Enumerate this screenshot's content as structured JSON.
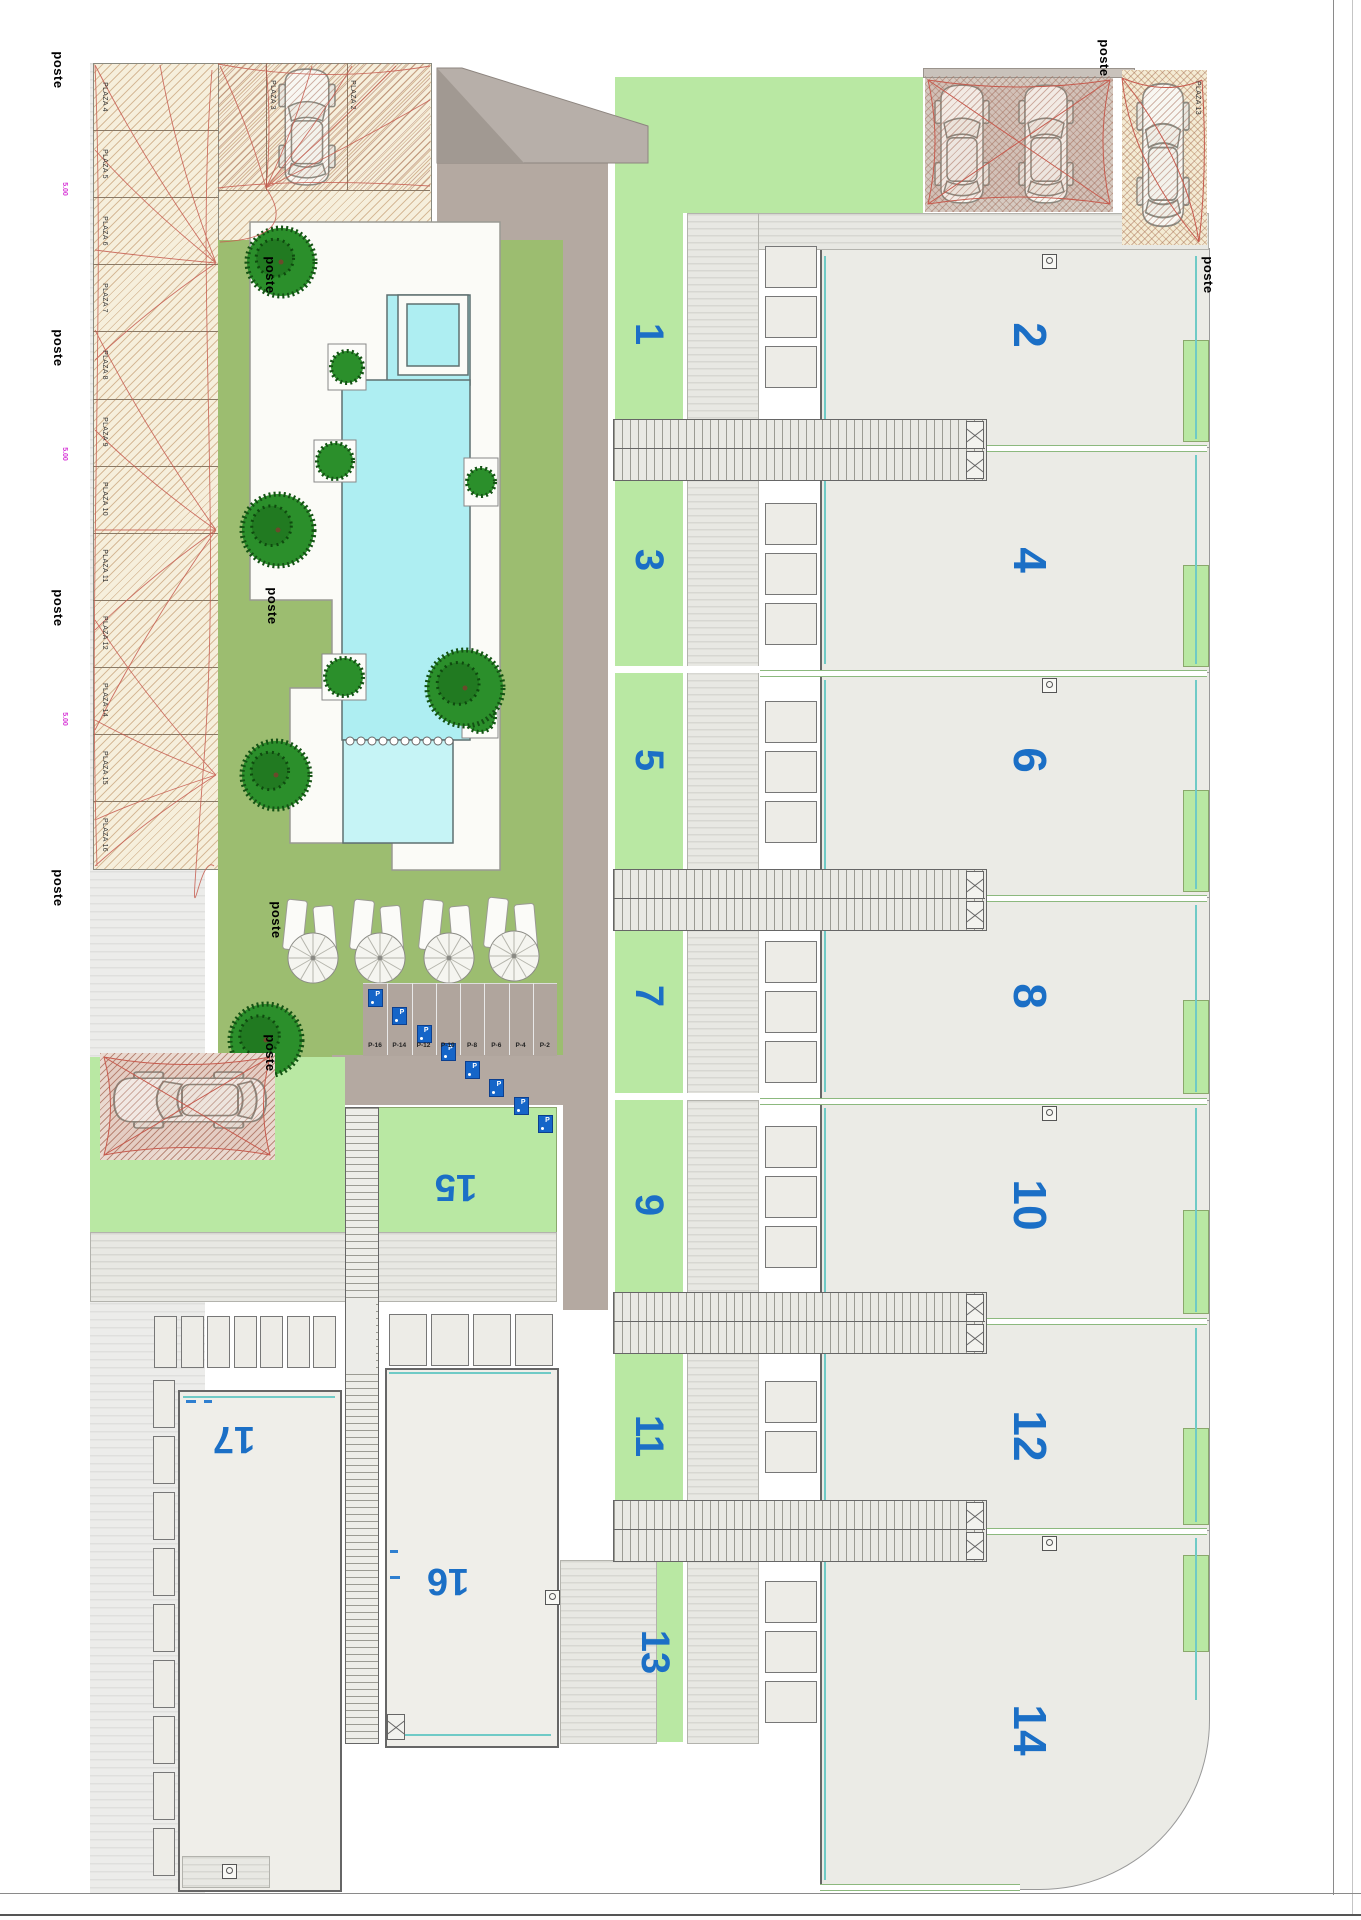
{
  "drawing": {
    "poste_label": "poste",
    "dimension_label": "5.00",
    "left_parking_plazas": [
      "PLAZA 4",
      "PLAZA 5",
      "PLAZA 6",
      "PLAZA 7",
      "PLAZA 8",
      "PLAZA 9",
      "PLAZA 10",
      "PLAZA 11",
      "PLAZA 12",
      "PLAZA 14",
      "PLAZA 15",
      "PLAZA 16"
    ],
    "top_parking_plazas": [
      "PLAZA 3",
      "PLAZA 2"
    ],
    "right_parking_plaza": "PLAZA 13",
    "pool": {
      "jacuzzi": "JACUZZI",
      "name": "PISCINA",
      "area": "61,23",
      "kids_zone": "ZONA INFANTIL"
    },
    "street_parking_spaces": [
      "P-16",
      "P-14",
      "P-12",
      "P-10",
      "P-8",
      "P-6",
      "P-4",
      "P-2"
    ],
    "parking_sign_letter": "P",
    "units_odd": [
      "1",
      "3",
      "5",
      "7",
      "9",
      "11",
      "13"
    ],
    "units_even": [
      "2",
      "4",
      "6",
      "8",
      "10",
      "12",
      "14"
    ],
    "units_bottom": [
      "15",
      "16",
      "17"
    ],
    "colors": {
      "unit_number": "#1b6fc6",
      "garden_olive": "#9cbd70",
      "lawn_bright": "#b9e8a3",
      "pool_water": "#aeeef2",
      "kids_water": "#c6f4f6",
      "road": "#b4a9a1",
      "sail_red": "#c65b4e",
      "parking_sand": "#f6efdc",
      "teal_line": "#6fcac6",
      "boundary_green": "#8cb97e",
      "magenta_dim": "#d633d6"
    }
  }
}
